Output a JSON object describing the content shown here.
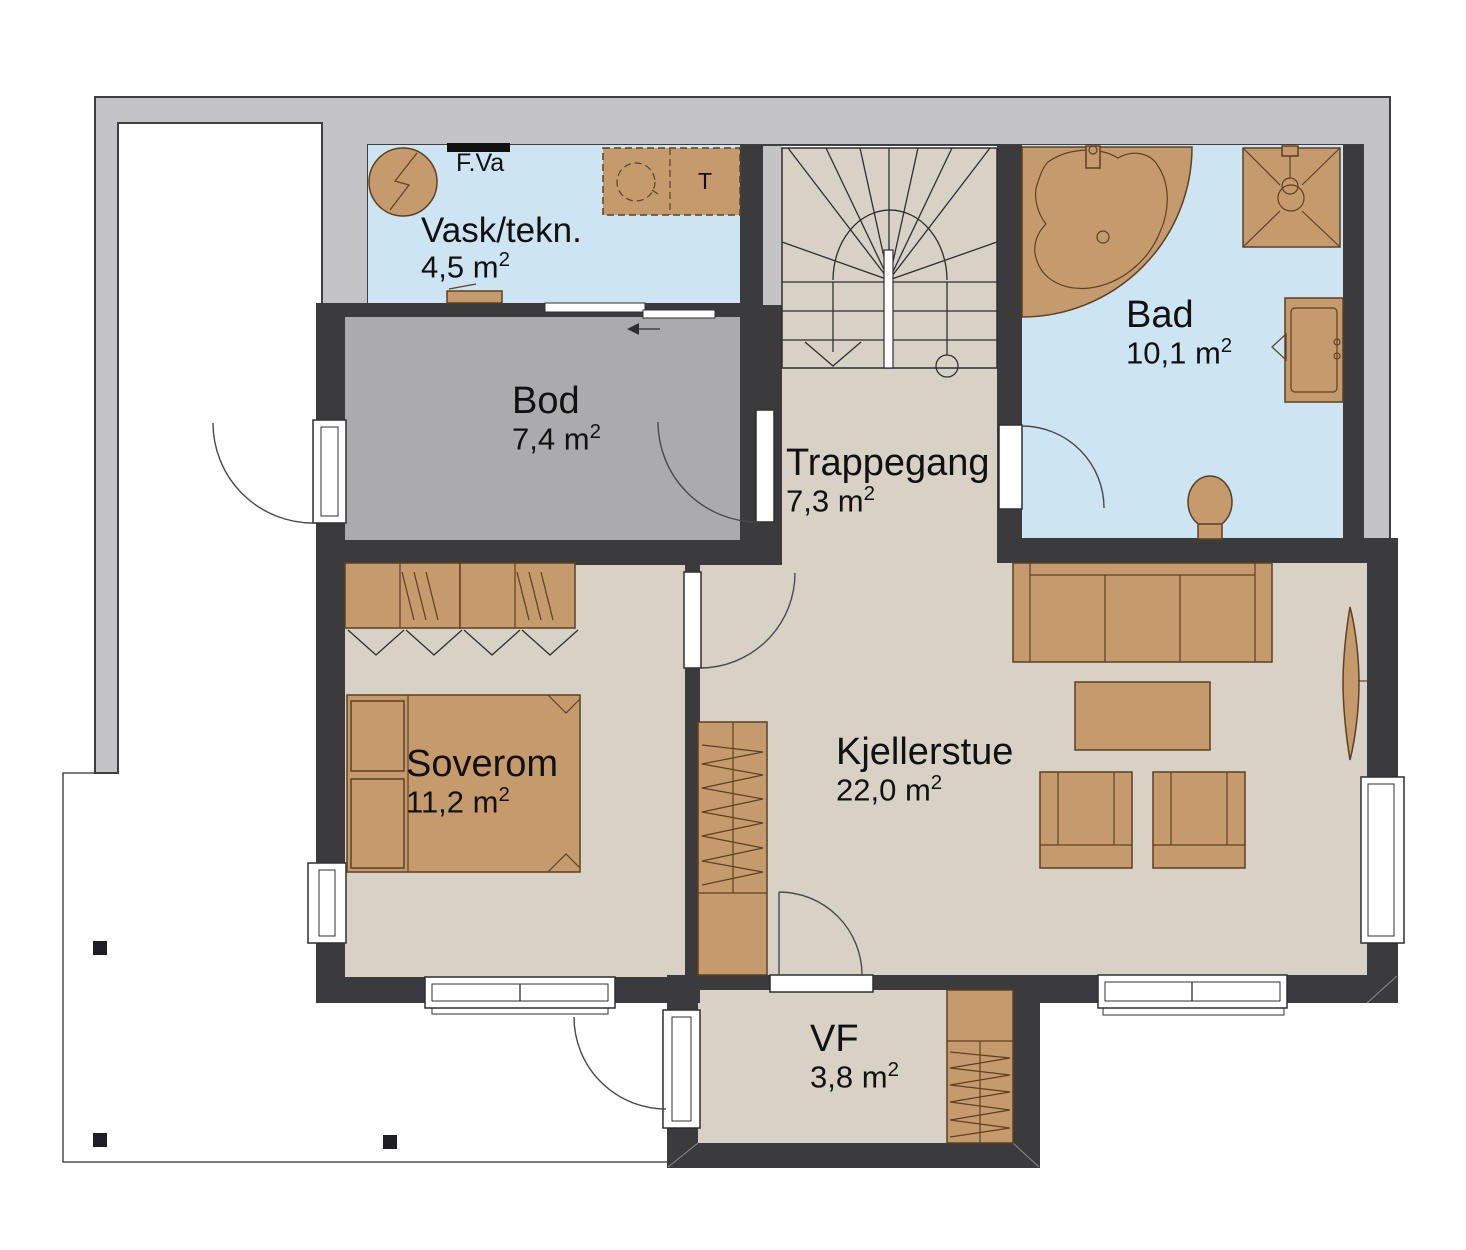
{
  "meta": {
    "area_unit": "m",
    "area_sup": "2"
  },
  "rooms": [
    {
      "id": "vask",
      "name": "Vask/tekn.",
      "area": "4,5"
    },
    {
      "id": "bod",
      "name": "Bod",
      "area": "7,4"
    },
    {
      "id": "trappegang",
      "name": "Trappegang",
      "area": "7,3"
    },
    {
      "id": "bad",
      "name": "Bad",
      "area": "10,1"
    },
    {
      "id": "soverom",
      "name": "Soverom",
      "area": "11,2"
    },
    {
      "id": "kjellerstue",
      "name": "Kjellerstue",
      "area": "22,0"
    },
    {
      "id": "vf",
      "name": "VF",
      "area": "3,8"
    }
  ],
  "annotations": {
    "water_cabinet": "F.Va",
    "dryer": "T"
  },
  "colors": {
    "wall": "#3b3b3d",
    "band": "#c4c4c6",
    "beige": "#d8d1c5",
    "blue": "#cde4f3",
    "gray": "#ababad",
    "furn": "#c59b6d"
  }
}
